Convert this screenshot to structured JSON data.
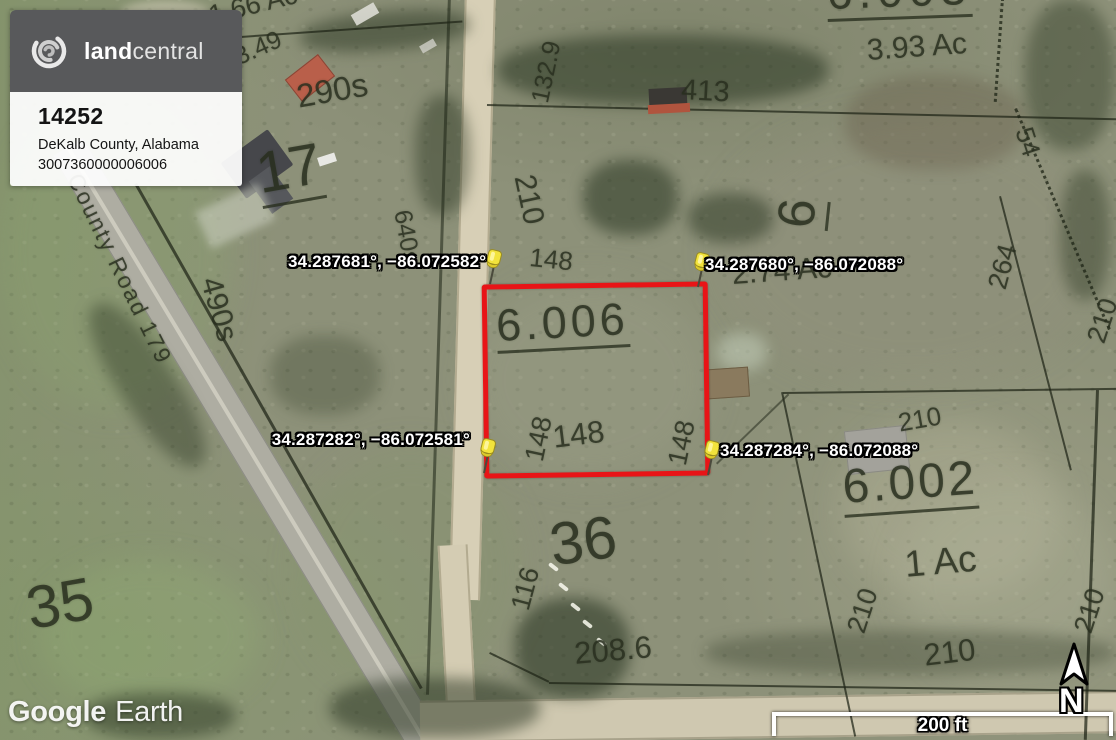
{
  "overlay": {
    "listing_card": {
      "brand_land": "land",
      "brand_central": "central",
      "listing_id": "14252",
      "location": "DeKalb County, Alabama",
      "apn": "3007360000006006"
    },
    "watermark_google": "Google",
    "watermark_earth": "Earth",
    "scale_bar_label": "200 ft",
    "north_label": "N"
  },
  "pins": {
    "top_left": {
      "coords": "34.287681°, −86.072582°"
    },
    "top_right": {
      "coords": "34.287680°, −86.072088°"
    },
    "bottom_left": {
      "coords": "34.287282°, −86.072581°"
    },
    "bottom_right": {
      "coords": "34.287284°, −86.072088°"
    }
  },
  "highlighted_parcel": {
    "number": "6.006",
    "outline_color": "#e81417"
  },
  "colors": {
    "card_header": "#58595b",
    "pin_yellow": "#f2e33c",
    "map_ink": "rgba(40,46,30,0.82)"
  },
  "map_labels": [
    {
      "text": "1.66 Ac",
      "x": 206,
      "y": 3,
      "size": 27,
      "rot": -14
    },
    {
      "text": "3.49",
      "x": 231,
      "y": 47,
      "size": 25,
      "rot": -24
    },
    {
      "text": "290s",
      "x": 294,
      "y": 80,
      "size": 33,
      "rot": -10
    },
    {
      "text": "17",
      "x": 252,
      "y": 146,
      "size": 58,
      "rot": -10,
      "u": true
    },
    {
      "text": "County Road 179",
      "x": 84,
      "y": 170,
      "size": 23,
      "rot": 64,
      "ls": 2
    },
    {
      "text": "490s",
      "x": 224,
      "y": 274,
      "size": 30,
      "rot": 74
    },
    {
      "text": "640s",
      "x": 414,
      "y": 208,
      "size": 25,
      "rot": 80
    },
    {
      "text": "210",
      "x": 538,
      "y": 172,
      "size": 30,
      "rot": 78
    },
    {
      "text": "132.9",
      "x": 528,
      "y": 100,
      "size": 25,
      "rot": -78
    },
    {
      "text": "148",
      "x": 531,
      "y": 244,
      "size": 26,
      "rot": 6
    },
    {
      "text": "413",
      "x": 682,
      "y": 76,
      "size": 29,
      "rot": 3
    },
    {
      "text": "6.003",
      "x": 826,
      "y": -30,
      "size": 46,
      "rot": -2,
      "u": true,
      "ls": 6
    },
    {
      "text": "3.93 Ac",
      "x": 866,
      "y": 36,
      "size": 30,
      "rot": -4
    },
    {
      "text": "54",
      "x": 1036,
      "y": 124,
      "size": 26,
      "rot": 72
    },
    {
      "text": "6",
      "x": 770,
      "y": 225,
      "size": 52,
      "rot": -84,
      "u": true
    },
    {
      "text": "2.74 Ac",
      "x": 731,
      "y": 260,
      "size": 30,
      "rot": -4
    },
    {
      "text": "264",
      "x": 984,
      "y": 285,
      "size": 27,
      "rot": -75
    },
    {
      "text": "210",
      "x": 1083,
      "y": 338,
      "size": 27,
      "rot": -72
    },
    {
      "text": "6.006",
      "x": 495,
      "y": 303,
      "size": 45,
      "rot": -3,
      "u": true,
      "ls": 4
    },
    {
      "text": "148",
      "x": 521,
      "y": 458,
      "size": 27,
      "rot": -78
    },
    {
      "text": "148",
      "x": 551,
      "y": 422,
      "size": 31,
      "rot": -7
    },
    {
      "text": "148",
      "x": 664,
      "y": 462,
      "size": 27,
      "rot": -78
    },
    {
      "text": "210",
      "x": 896,
      "y": 410,
      "size": 26,
      "rot": -10
    },
    {
      "text": "6.002",
      "x": 841,
      "y": 464,
      "size": 48,
      "rot": -4,
      "u": true,
      "ls": 3
    },
    {
      "text": "1 Ac",
      "x": 903,
      "y": 546,
      "size": 37,
      "rot": -5
    },
    {
      "text": "210",
      "x": 843,
      "y": 628,
      "size": 27,
      "rot": -72
    },
    {
      "text": "210",
      "x": 1070,
      "y": 628,
      "size": 27,
      "rot": -72
    },
    {
      "text": "35",
      "x": 22,
      "y": 580,
      "size": 60,
      "rot": -10
    },
    {
      "text": "36",
      "x": 546,
      "y": 516,
      "size": 60,
      "rot": -8
    },
    {
      "text": "116",
      "x": 507,
      "y": 606,
      "size": 27,
      "rot": -75
    },
    {
      "text": "208.6",
      "x": 573,
      "y": 638,
      "size": 31,
      "rot": -5
    },
    {
      "text": "210",
      "x": 922,
      "y": 640,
      "size": 31,
      "rot": -7
    }
  ]
}
